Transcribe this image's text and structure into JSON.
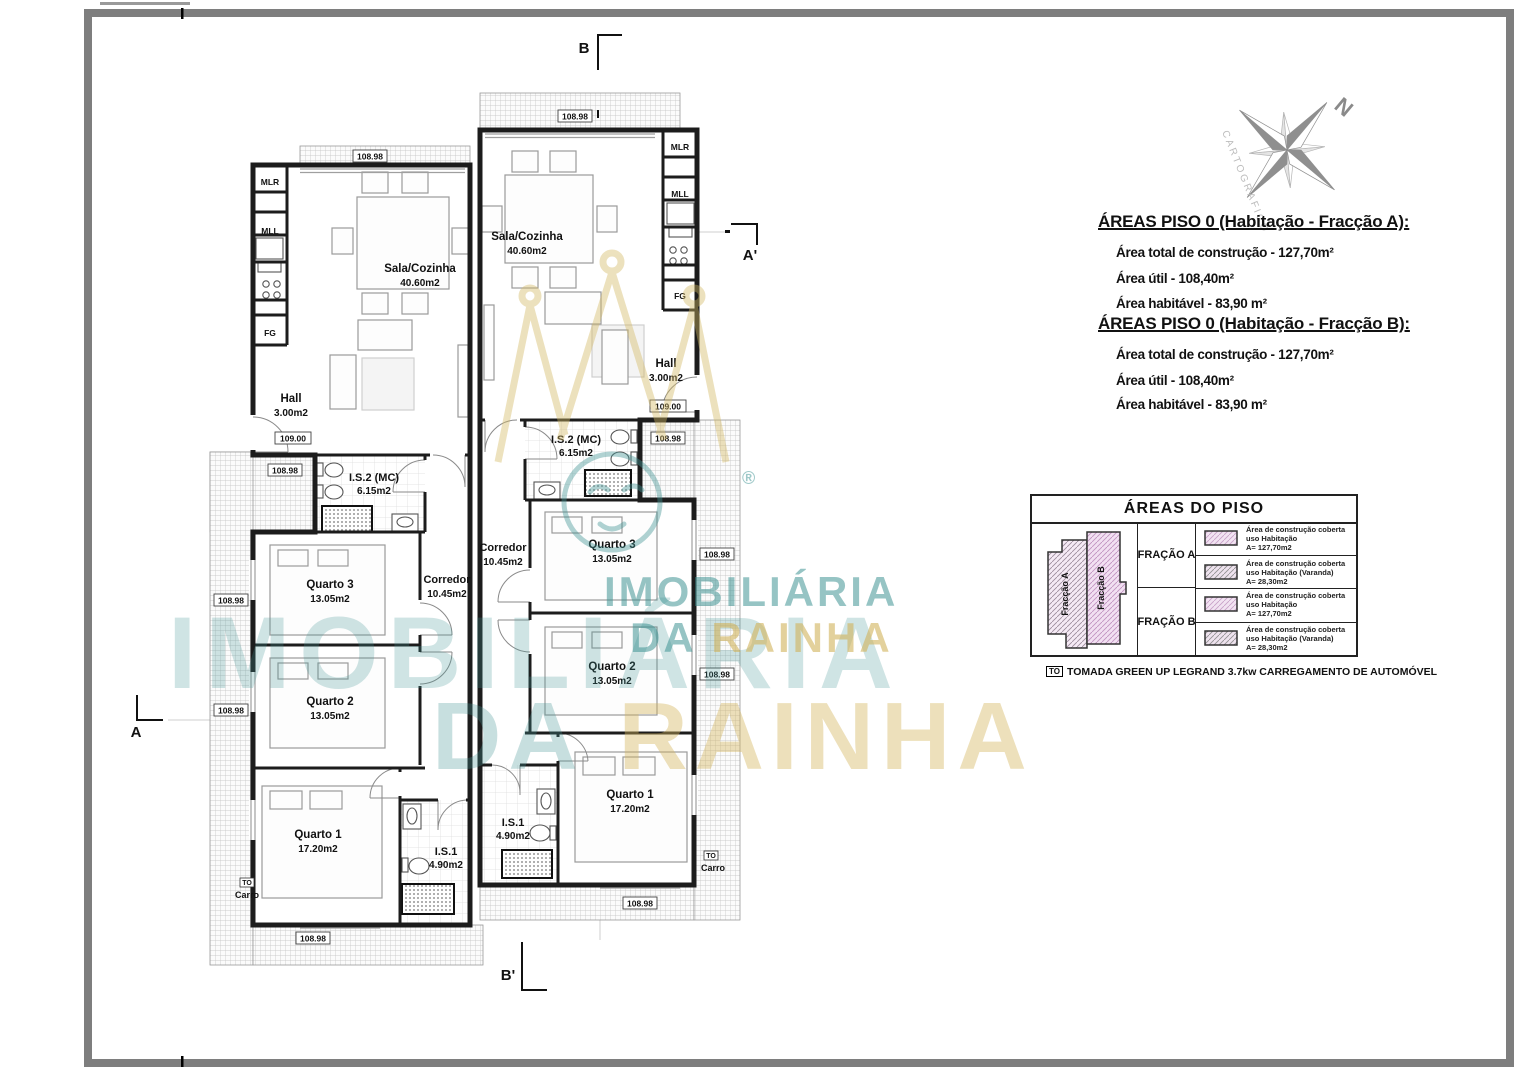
{
  "plan": {
    "dims": {
      "d": "108.98",
      "level": "109.00"
    },
    "to": {
      "tag": "TO",
      "label": "Carro"
    },
    "sections": {
      "a": "A",
      "a2": "A'",
      "b": "B",
      "b2": "B'"
    },
    "kitchen": {
      "mlr": "MLR",
      "mll": "MLL",
      "fg": "FG"
    },
    "rooms": {
      "sala": {
        "name": "Sala/Cozinha",
        "area": "40.60m2"
      },
      "hall": {
        "name": "Hall",
        "area": "3.00m2"
      },
      "is2": {
        "name": "I.S.2 (MC)",
        "area": "6.15m2"
      },
      "q3": {
        "name": "Quarto 3",
        "area": "13.05m2"
      },
      "corredor": {
        "name": "Corredor",
        "area": "10.45m2"
      },
      "q2": {
        "name": "Quarto 2",
        "area": "13.05m2"
      },
      "q1": {
        "name": "Quarto 1",
        "area": "17.20m2"
      },
      "is1": {
        "name": "I.S.1",
        "area": "4.90m2"
      }
    }
  },
  "compass": {
    "north": "N",
    "label": "CARTOGRAFICO"
  },
  "areas_panel": {
    "title_a": "ÁREAS PISO 0 (Habitação - Fracção A):",
    "title_b": "ÁREAS PISO 0 (Habitação - Fracção B):",
    "line1": "Área total de construção - 127,70m²",
    "line2": "Área útil - 108,40m²",
    "line3": "Área habitável - 83,90 m²"
  },
  "legend": {
    "title": "ÁREAS DO PISO",
    "fraction_a": "FRAÇÃO A",
    "fraction_b": "FRAÇÃO B",
    "mini": {
      "a": "Fracção A",
      "b": "Fracção B"
    },
    "entries": [
      {
        "l1": "Área de construção coberta",
        "l2": "uso Habitação",
        "l3": "A= 127,70m2"
      },
      {
        "l1": "Área de construção coberta",
        "l2": "uso Habitação (Varanda)",
        "l3": "A= 28,30m2"
      },
      {
        "l1": "Área de construção coberta",
        "l2": "uso Habitação",
        "l3": "A= 127,70m2"
      },
      {
        "l1": "Área de construção coberta",
        "l2": "uso Habitação (Varanda)",
        "l3": "A= 28,30m2"
      }
    ]
  },
  "note": {
    "tag": "TO",
    "text": "TOMADA GREEN UP LEGRAND 3.7kw CARREGAMENTO DE AUTOMÓVEL"
  },
  "watermark": {
    "brand1": "IMOBILIÁRIA",
    "brand2_da": "DA",
    "brand2_rainha": "RAINHA",
    "big1": "IMOBILIÁRIA",
    "big2_da": "DA",
    "big2_rainha": "RAINHA",
    "reg": "®"
  },
  "colors": {
    "teal": "#409494",
    "gold": "#d4b964",
    "pink": "#f2e3f2"
  }
}
